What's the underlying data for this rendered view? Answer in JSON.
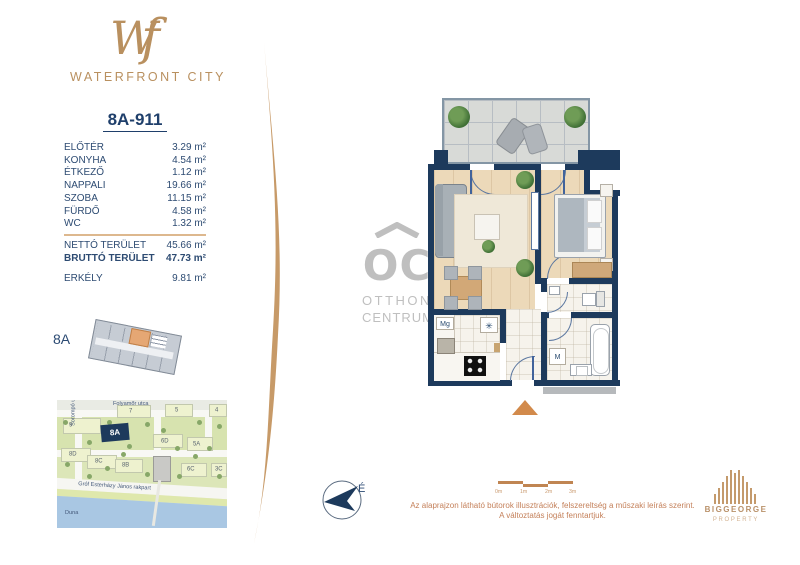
{
  "brand": {
    "monogram": "Wf",
    "name": "WATERFRONT CITY"
  },
  "unit": {
    "id": "8A-911",
    "rooms": [
      {
        "label": "ELŐTÉR",
        "area": "3.29 m²"
      },
      {
        "label": "KONYHA",
        "area": "4.54 m²"
      },
      {
        "label": "ÉTKEZŐ",
        "area": "1.12 m²"
      },
      {
        "label": "NAPPALI",
        "area": "19.66 m²"
      },
      {
        "label": "SZOBA",
        "area": "11.15 m²"
      },
      {
        "label": "FÜRDŐ",
        "area": "4.58 m²"
      },
      {
        "label": "WC",
        "area": "1.32 m²"
      }
    ],
    "totals": [
      {
        "label": "NETTÓ TERÜLET",
        "area": "45.66 m²"
      },
      {
        "label": "BRUTTÓ TERÜLET",
        "area": "47.73 m²"
      }
    ],
    "extras": [
      {
        "label": "ERKÉLY",
        "area": "9.81 m²"
      }
    ]
  },
  "building_key": {
    "label": "8A"
  },
  "floorplan": {
    "labels": {
      "dishwasher": "Mg",
      "fridge": "✳",
      "washer": "M"
    }
  },
  "watermark": {
    "monogram": "OC",
    "line1": "OTTHON",
    "line2": "CENTRUM"
  },
  "compass": {
    "north": "É"
  },
  "scale_bar": {
    "ticks": [
      "0m",
      "1m",
      "2m",
      "3m"
    ]
  },
  "disclaimer": {
    "line1": "Az alaprajzon látható bútorok illusztrációk, felszereltség a műszaki leírás szerint.",
    "line2": "A változtatás jogát fenntartjuk."
  },
  "developer": {
    "name": "BIGGEORGE",
    "division": "PROPERTY"
  },
  "map": {
    "streets": {
      "top": "Folyamőr utca",
      "left": "Sorompó utca",
      "embankment": "Gróf Esterházy János rakpart",
      "river": "Duna"
    },
    "highlight": "8A",
    "buildings": [
      "9",
      "7",
      "5",
      "4",
      "6D",
      "5A",
      "8D",
      "8C",
      "8B",
      "6C",
      "3C"
    ]
  },
  "colors": {
    "gold": "#BF9260",
    "navy_text": "#2D4B72",
    "wall_navy": "#1D3A5C",
    "highlight_orange": "#E5A774",
    "river_blue": "#A9C7E3"
  }
}
